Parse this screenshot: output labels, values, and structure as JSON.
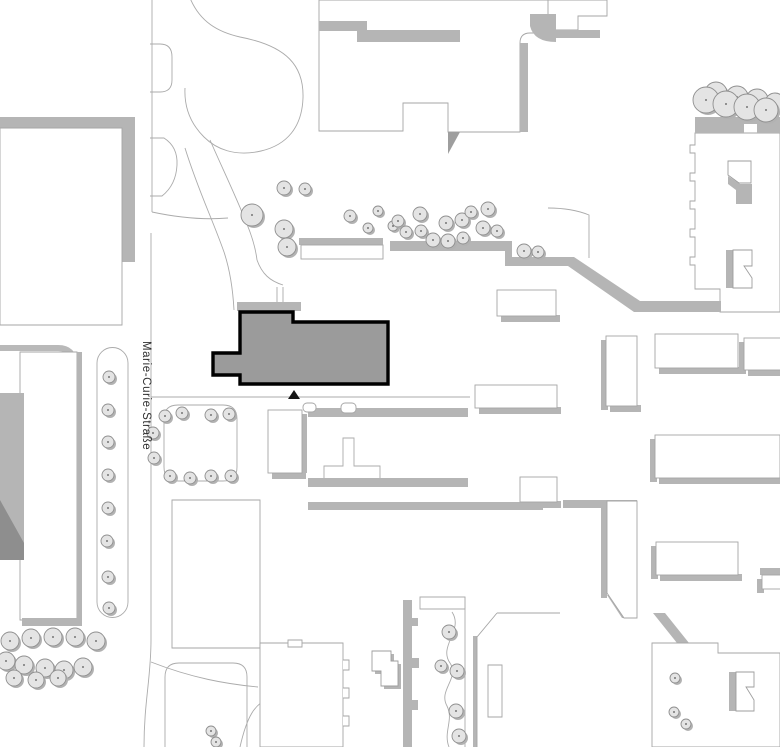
{
  "map": {
    "title": "site-plan",
    "street_label": {
      "text": "Marie-Curie-Straße",
      "transform": "translate(143,341) rotate(90)",
      "color": "#2f2f2f"
    },
    "colors": {
      "background": "#ffffff",
      "outline": "#a6a6a6",
      "path_line": "#ababab",
      "shadow": "#b5b5b5",
      "shadow_dark": "#8e8e8e",
      "highlight_fill": "#9b9b9b",
      "highlight_stroke": "#000000",
      "tree_fill": "#e4e4e4",
      "tree_stroke": "#8f8f8f",
      "tree_dot": "#555555",
      "tree_shadow": "#b2b2b2"
    },
    "highlight": {
      "name": "highlighted-building",
      "points": "240,312 293,312 293,322 388,322 388,384 240,384 240,375 213,375 213,353 240,353"
    },
    "entrance_marker": {
      "points": "288,399 300,399 294,390"
    },
    "shapes": [
      {
        "n": "street-edge-top",
        "d": "M152,0 L152,212",
        "s": "#ababab"
      },
      {
        "n": "street-island-small",
        "d": "M150,44 L160,44 Q172,44 172,57 L172,80 Q172,92 160,92 L150,92",
        "s": "#ababab"
      },
      {
        "n": "street-island-mid",
        "d": "M150,138 L164,138 Q178,147 177,165 Q176,185 162,196 L150,196",
        "s": "#ababab"
      },
      {
        "n": "plaza-lawn-outline",
        "d": "M190,-2 C200,22 218,32 240,37 C287,46 304,66 303,98 C302,127 287,145 261,151 C235,157 216,149 204,137 C191,124 184,108 185,88",
        "s": "#ababab"
      },
      {
        "n": "plaza-path",
        "d": "M152,212 C180,218 205,220 228,218",
        "s": "#ababab"
      },
      {
        "n": "footpath-a",
        "d": "M185,148 C198,190 212,218 224,252 C230,270 233,292 234,310",
        "s": "#ababab"
      },
      {
        "n": "footpath-b",
        "d": "M210,140 C224,172 240,205 250,232 C254,243 256,252 257,260",
        "s": "#ababab"
      },
      {
        "n": "footpath-c",
        "d": "M257,260 C262,274 270,281 283,285 M277,287 L277,310 M283,287 L283,310",
        "s": "#ababab"
      },
      {
        "n": "street-edge-main",
        "d": "M151,233 L151,640 C151,678 144,702 144,747",
        "s": "#ababab"
      },
      {
        "n": "walkway-line",
        "d": "M151,397 L470,397",
        "s": "#ababab"
      },
      {
        "n": "bottom-path-a",
        "d": "M151,662 C192,678 226,684 258,687",
        "s": "#ababab"
      },
      {
        "n": "bottom-path-b",
        "d": "M240,747 C247,716 255,704 268,699",
        "s": "#ababab"
      },
      {
        "n": "bottom-path-c",
        "d": "M305,747 C312,718 330,705 343,701",
        "s": "#ababab"
      },
      {
        "n": "ne-plaza-path",
        "d": "M548,208 Q572,208 589,215 L589,258",
        "s": "#ababab"
      },
      {
        "n": "tl-building-shadow-top",
        "d": "M0,117 L135,117 L135,128 L0,128 Z",
        "f": "#b5b5b5"
      },
      {
        "n": "tl-building-shadow-right",
        "d": "M122,128 L135,128 L135,262 L122,262 Z",
        "f": "#b5b5b5"
      },
      {
        "n": "tl-building",
        "d": "M0,128 L122,128 L122,325 L0,325 Z",
        "f": "#ffffff",
        "s": "#a6a6a6"
      },
      {
        "n": "tc-building",
        "d": "M319,0 L319,131 L403,131 L403,103 L448,103 L448,132 L520,132 L520,43 Q520,33 530,33 L538,33 L538,20 L558,20 L558,0 Z",
        "f": "#ffffff",
        "s": "#a6a6a6"
      },
      {
        "n": "tc-shadow-a",
        "d": "M319,21 L367,21 L367,31 L319,31 Z",
        "f": "#b5b5b5"
      },
      {
        "n": "tc-shadow-b",
        "d": "M357,30 L460,30 L460,42 L357,42 Z",
        "f": "#b5b5b5"
      },
      {
        "n": "tc-shadow-right",
        "d": "M520,43 L528,43 L528,132 L520,132 Z",
        "f": "#b5b5b5"
      },
      {
        "n": "tc-shadow-wedge",
        "d": "M448,132 L460,132 L448,154 Z",
        "f": "#9e9e9e"
      },
      {
        "n": "tr-piece",
        "d": "M548,0 L607,0 L607,16 L578,16 L578,30 L548,30 Z",
        "f": "#ffffff",
        "s": "#a6a6a6"
      },
      {
        "n": "tr-shadow",
        "d": "M548,30 L600,30 L600,38 L548,38 Z",
        "f": "#b5b5b5"
      },
      {
        "n": "tr-hook-shadow",
        "d": "M530,14 L556,14 L556,42 Q534,42 530,26 Z",
        "f": "#b5b5b5"
      },
      {
        "n": "rj-building",
        "d": "M695,133 L780,133 L780,312 L720,312 L720,289 L695,289 L695,265 L690,265 L690,257 L695,257 L695,237 L690,237 L690,229 L695,229 L695,209 L690,209 L690,201 L695,201 L695,181 L690,181 L690,173 L695,173 L695,153 L690,153 L690,145 L695,145 Z",
        "f": "#ffffff",
        "s": "#a6a6a6"
      },
      {
        "n": "rj-roof-shadow",
        "d": "M695,117 L780,117 L780,133 L757,133 L757,124 L744,124 L744,133 L695,133 Z",
        "f": "#b5b5b5"
      },
      {
        "n": "rj-courtyard-a-shadow",
        "d": "M728,176 L740,184 L752,184 L752,204 L736,204 L736,190 L728,184 Z",
        "f": "#b5b5b5"
      },
      {
        "n": "rj-courtyard-a",
        "d": "M728,161 L751,161 L751,183 L739,183 L728,175 Z",
        "f": "#ffffff",
        "s": "#9e9e9e"
      },
      {
        "n": "rj-courtyard-b-shadow",
        "d": "M726,250 L733,250 L733,288 L726,288 Z",
        "f": "#b5b5b5"
      },
      {
        "n": "rj-courtyard-b",
        "d": "M733,250 L752,250 L752,266 L744,266 L752,278 L752,288 L733,288 Z",
        "f": "#ffffff",
        "s": "#9e9e9e"
      },
      {
        "n": "retaining-wall",
        "d": "M390,241 L512,241 L512,257 L574,257 L640,301 L721,301 L721,312 L634,312 L568,266 L505,266 L505,251 L390,251 Z",
        "f": "#b5b5b5"
      },
      {
        "n": "highlight-shadow",
        "d": "M237,302 L301,302 L301,311 L237,311 Z",
        "f": "#b5b5b5"
      },
      {
        "n": "bl-block-corner",
        "d": "M0,348 L58,348 Q74,348 74,364 L74,618",
        "s": "#b9b9b9",
        "w": 6
      },
      {
        "n": "bl-building",
        "d": "M20,352 L77,352 L77,620 L20,620 Z",
        "f": "#ffffff",
        "s": "#a6a6a6"
      },
      {
        "n": "bl-hall-gray",
        "d": "M0,393 L24,393 L24,560 L0,560 Z",
        "f": "#b5b5b5"
      },
      {
        "n": "bl-hall-dark",
        "d": "M0,500 L24,543 L24,560 L0,560 Z",
        "f": "#8e8e8e"
      },
      {
        "n": "bl-shadow-right",
        "d": "M77,352 L82,352 L82,620 L77,620 Z",
        "f": "#b5b5b5"
      },
      {
        "n": "bl-shadow-bottom",
        "d": "M22,618 L82,618 L82,626 L22,626 Z",
        "f": "#b5b5b5"
      },
      {
        "n": "median-strip",
        "d": "M97,363 A15.5,15.5 0 0 1 128,363 L128,602 A15.5,15.5 0 0 1 97,602 Z",
        "f": "#ffffff",
        "s": "#ababab"
      },
      {
        "n": "planter",
        "d": "M164,419 Q164,405 178,405 L223,405 Q237,405 237,419 L237,467 Q237,481 223,481 L178,481 Q164,481 164,467 Z",
        "f": "#ffffff",
        "s": "#ababab"
      },
      {
        "n": "t-path",
        "d": "M343,438 L354,438 L354,466 L380,466 L380,480 L324,480 L324,466 L343,466 Z",
        "f": "#ffffff",
        "s": "#ababab"
      },
      {
        "n": "row-band-a",
        "d": "M308,408 L468,408 L468,417 L308,417 Z",
        "f": "#b5b5b5"
      },
      {
        "n": "row-band-b",
        "d": "M308,478 L468,478 L468,487 L308,487 Z",
        "f": "#b5b5b5"
      },
      {
        "n": "row-band-c",
        "d": "M308,502 L543,502 L543,510 L308,510 Z",
        "f": "#b5b5b5"
      },
      {
        "n": "row-band-d",
        "d": "M563,500 L637,500 L637,508 L563,508 Z",
        "f": "#b5b5b5"
      },
      {
        "n": "sv-slab-shadow",
        "d": "M601,503 L607,503 L607,598 L601,598 Z",
        "f": "#b5b5b5"
      },
      {
        "n": "sv-slab-diag-shadow",
        "d": "M607,595 L622,618 L631,618 L614,595 Z",
        "f": "#b5b5b5"
      },
      {
        "n": "sv-slab",
        "d": "M607,501 L637,501 L637,618 L624,618 L607,593 Z",
        "f": "#ffffff",
        "s": "#a6a6a6"
      },
      {
        "n": "blc-building",
        "d": "M172,500 L260,500 L260,648 L172,648 Z",
        "f": "#ffffff",
        "s": "#a6a6a6"
      },
      {
        "n": "blc-court",
        "d": "M165,677 Q165,663 179,663 L233,663 Q247,663 247,677 L247,753 L165,753 Z",
        "s": "#ababab"
      },
      {
        "n": "bm-building",
        "d": "M260,643 L343,643 L343,747 L260,747 Z",
        "f": "#ffffff",
        "s": "#a6a6a6"
      },
      {
        "n": "bm-teeth",
        "d": "M343,660 h6 v10 h-6 M343,688 h6 v10 h-6 M343,716 h6 v10 h-6",
        "f": "#ffffff",
        "s": "#a6a6a6"
      },
      {
        "n": "bm-notch",
        "d": "M288,640 h14 v7 h-14 Z",
        "f": "#ffffff",
        "s": "#a6a6a6"
      },
      {
        "n": "flag-shadow",
        "d": "M375,654 L394,654 L394,664 L401,664 L401,689 L384,689 L384,674 L375,674 Z",
        "f": "#b5b5b5"
      },
      {
        "n": "flag",
        "d": "M372,651 L391,651 L391,661 L398,661 L398,686 L381,686 L381,671 L372,671 Z",
        "f": "#ffffff",
        "s": "#9e9e9e"
      },
      {
        "n": "wavy-wall",
        "d": "M403,600 L412,600 L412,618 L418,618 L418,626 L412,626 L412,658 L419,658 L419,668 L412,668 L412,700 L418,700 L418,710 L412,710 L412,747 L403,747 Z",
        "f": "#b5b5b5"
      },
      {
        "n": "wavy-cap",
        "d": "M420,597 L465,597 L465,609 L420,609 Z",
        "f": "#ffffff",
        "s": "#ababab"
      },
      {
        "n": "wavy-path",
        "d": "M452,612 C464,630 438,646 450,663 C460,678 438,690 447,706 C454,720 443,732 449,747",
        "s": "#ababab"
      },
      {
        "n": "wavy-right-edge",
        "d": "M465,597 L465,747",
        "s": "#ababab"
      },
      {
        "n": "se-face-shadow",
        "d": "M473,636 L477,636 L477,747 L473,747 Z",
        "f": "#b5b5b5"
      },
      {
        "n": "se-lines",
        "d": "M497,613 L477,637 L477,747 M497,613 L560,613",
        "s": "#a6a6a6"
      },
      {
        "n": "se-rect",
        "d": "M488,665 L502,665 L502,717 L488,717 Z",
        "f": "#ffffff",
        "s": "#a6a6a6"
      },
      {
        "n": "se-diag-shadow",
        "d": "M653,613 L665,613 L689,643 L677,643 Z",
        "f": "#b5b5b5"
      },
      {
        "n": "br-building",
        "d": "M652,643 L718,643 L718,653 L780,653 L780,747 L652,747 Z",
        "f": "#ffffff",
        "s": "#a6a6a6"
      },
      {
        "n": "br-court-shadow",
        "d": "M729,672 L736,672 L736,711 L729,711 Z",
        "f": "#b5b5b5"
      },
      {
        "n": "br-court",
        "d": "M736,672 L754,672 L754,687 L746,687 L754,700 L754,711 L736,711 Z",
        "f": "#ffffff",
        "s": "#9e9e9e"
      }
    ],
    "slabs": [
      {
        "n": "slab-upper",
        "x": 301,
        "y": 245,
        "w": 82,
        "h": 14,
        "sh": [
          "t"
        ]
      },
      {
        "n": "slab-a",
        "x": 497,
        "y": 290,
        "w": 59,
        "h": 26,
        "sh": [
          "b"
        ]
      },
      {
        "n": "slab-b",
        "x": 606,
        "y": 336,
        "w": 31,
        "h": 70,
        "sh": [
          "l",
          "b"
        ]
      },
      {
        "n": "slab-c",
        "x": 655,
        "y": 334,
        "w": 83,
        "h": 34,
        "sh": [
          "b"
        ]
      },
      {
        "n": "slab-d",
        "x": 744,
        "y": 338,
        "w": 40,
        "h": 32,
        "sh": [
          "b",
          "l"
        ]
      },
      {
        "n": "slab-e",
        "x": 475,
        "y": 385,
        "w": 82,
        "h": 23,
        "sh": [
          "b"
        ]
      },
      {
        "n": "slab-f",
        "x": 520,
        "y": 477,
        "w": 37,
        "h": 25,
        "sh": [
          "b"
        ]
      },
      {
        "n": "slab-g",
        "x": 655,
        "y": 435,
        "w": 125,
        "h": 43,
        "sh": [
          "l",
          "b"
        ]
      },
      {
        "n": "slab-h",
        "x": 656,
        "y": 542,
        "w": 82,
        "h": 33,
        "sh": [
          "l",
          "b"
        ]
      },
      {
        "n": "slab-i",
        "x": 762,
        "y": 575,
        "w": 20,
        "h": 14,
        "sh": [
          "t",
          "l"
        ]
      },
      {
        "n": "slab-v",
        "x": 268,
        "y": 410,
        "w": 34,
        "h": 63,
        "sh": [
          "b",
          "r"
        ]
      },
      {
        "n": "tab-a",
        "x": 303,
        "y": 403,
        "w": 13,
        "h": 9,
        "rx": 4,
        "sh": []
      },
      {
        "n": "tab-b",
        "x": 341,
        "y": 403,
        "w": 15,
        "h": 10,
        "rx": 4,
        "sh": []
      }
    ],
    "trees": [
      [
        252,
        215,
        11
      ],
      [
        284,
        188,
        7
      ],
      [
        305,
        189,
        6
      ],
      [
        284,
        229,
        9
      ],
      [
        287,
        247,
        9
      ],
      [
        350,
        216,
        6
      ],
      [
        368,
        228,
        5
      ],
      [
        378,
        211,
        5
      ],
      [
        393,
        226,
        5
      ],
      [
        398,
        221,
        6
      ],
      [
        420,
        214,
        7
      ],
      [
        406,
        232,
        6
      ],
      [
        421,
        231,
        6
      ],
      [
        433,
        240,
        7
      ],
      [
        446,
        223,
        7
      ],
      [
        448,
        241,
        7
      ],
      [
        462,
        220,
        7
      ],
      [
        463,
        238,
        6
      ],
      [
        471,
        212,
        6
      ],
      [
        488,
        209,
        7
      ],
      [
        483,
        228,
        7
      ],
      [
        497,
        231,
        6
      ],
      [
        524,
        251,
        7
      ],
      [
        538,
        252,
        6
      ],
      [
        716,
        93,
        11
      ],
      [
        737,
        97,
        11
      ],
      [
        757,
        100,
        11
      ],
      [
        775,
        103,
        10
      ],
      [
        706,
        100,
        13
      ],
      [
        726,
        104,
        13
      ],
      [
        747,
        107,
        13
      ],
      [
        766,
        110,
        12
      ],
      [
        109,
        377,
        6
      ],
      [
        108,
        410,
        6
      ],
      [
        108,
        442,
        6
      ],
      [
        108,
        475,
        6
      ],
      [
        108,
        508,
        6
      ],
      [
        107,
        541,
        6
      ],
      [
        108,
        577,
        6
      ],
      [
        109,
        608,
        6
      ],
      [
        165,
        416,
        6
      ],
      [
        182,
        413,
        6
      ],
      [
        211,
        415,
        6
      ],
      [
        229,
        414,
        6
      ],
      [
        153,
        433,
        6
      ],
      [
        154,
        458,
        6
      ],
      [
        170,
        476,
        6
      ],
      [
        190,
        478,
        6
      ],
      [
        211,
        476,
        6
      ],
      [
        231,
        476,
        6
      ],
      [
        10,
        641,
        9
      ],
      [
        31,
        638,
        9
      ],
      [
        53,
        637,
        9
      ],
      [
        75,
        637,
        9
      ],
      [
        96,
        641,
        9
      ],
      [
        6,
        661,
        9
      ],
      [
        24,
        665,
        9
      ],
      [
        45,
        668,
        9
      ],
      [
        64,
        670,
        9
      ],
      [
        83,
        667,
        9
      ],
      [
        14,
        678,
        8
      ],
      [
        36,
        680,
        8
      ],
      [
        58,
        678,
        8
      ],
      [
        211,
        731,
        5
      ],
      [
        216,
        742,
        5
      ],
      [
        449,
        632,
        7
      ],
      [
        441,
        666,
        6
      ],
      [
        457,
        671,
        7
      ],
      [
        456,
        711,
        7
      ],
      [
        459,
        736,
        7
      ],
      [
        675,
        678,
        5
      ],
      [
        674,
        712,
        5
      ],
      [
        686,
        724,
        5
      ]
    ]
  }
}
